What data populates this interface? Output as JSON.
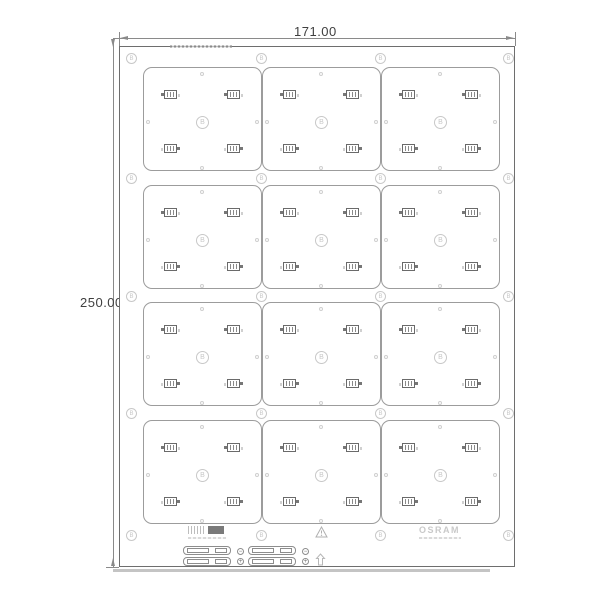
{
  "dimensions": {
    "width": "171.00",
    "height": "250.00"
  },
  "panel": {
    "cols_x": [
      143,
      262,
      381
    ],
    "rows_y": [
      67,
      185,
      302,
      420
    ],
    "board_w": 119,
    "board_h": 104,
    "board_marker": "B",
    "rail_fiducial": "B",
    "fiducial_xs": [
      131,
      261,
      380,
      508
    ],
    "fiducial_ys": [
      58,
      178,
      296,
      413,
      535
    ],
    "led_centers": [
      [
        26,
        26
      ],
      [
        89,
        26
      ],
      [
        26,
        80
      ],
      [
        89,
        80
      ]
    ],
    "hole_centers": [
      [
        58,
        6
      ],
      [
        58,
        100
      ],
      [
        4,
        54
      ],
      [
        113,
        54
      ]
    ],
    "marker_center": [
      58,
      54
    ]
  },
  "footer": {
    "right_logo": "OSRAM",
    "polarity_minus": "−",
    "polarity_plus": "+"
  }
}
